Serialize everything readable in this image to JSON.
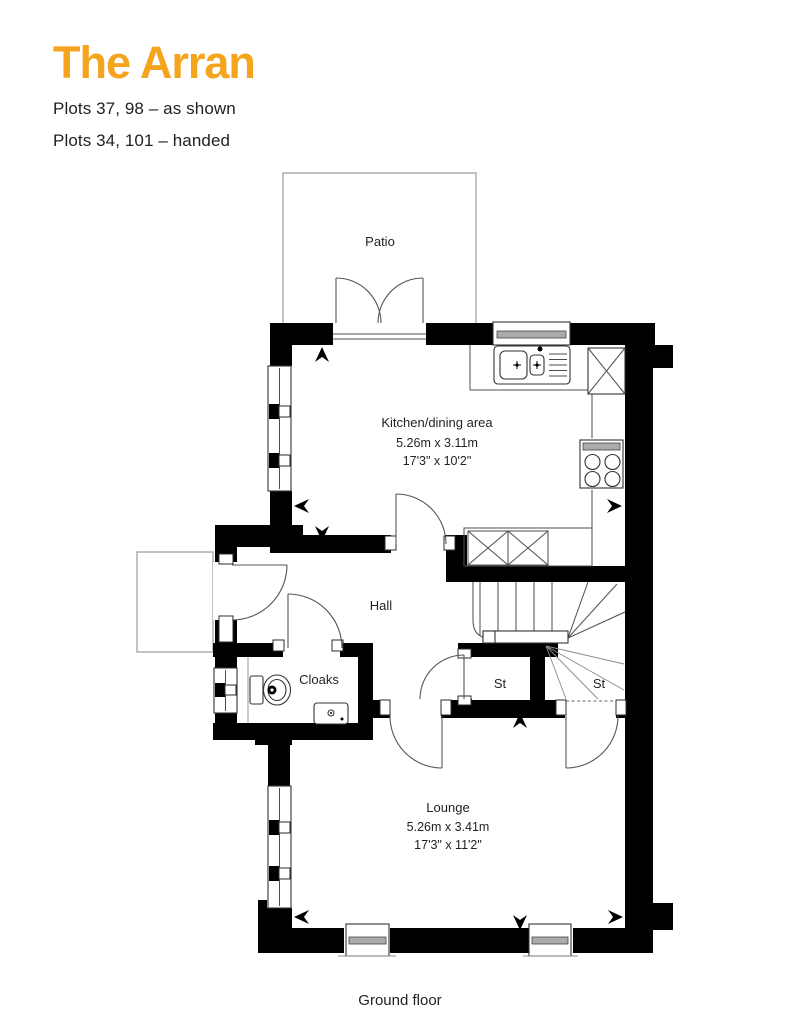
{
  "header": {
    "title": "The Arran",
    "plots_line_1": "Plots 37, 98 – as shown",
    "plots_line_2": "Plots 34, 101 – handed"
  },
  "caption": "Ground floor",
  "colors": {
    "accent_orange": "#F5A41E",
    "text": "#231F20",
    "walls": "#000000"
  },
  "plan": {
    "patio_label": "Patio",
    "hall_label": "Hall",
    "cloaks_label": "Cloaks",
    "store_left_label": "St",
    "store_right_label": "St",
    "kitchen": {
      "name": "Kitchen/dining area",
      "metric": "5.26m x 3.11m",
      "imperial": "17'3\" x 10'2\""
    },
    "lounge": {
      "name": "Lounge",
      "metric": "5.26m x 3.41m",
      "imperial": "17'3\" x 11'2\""
    }
  }
}
